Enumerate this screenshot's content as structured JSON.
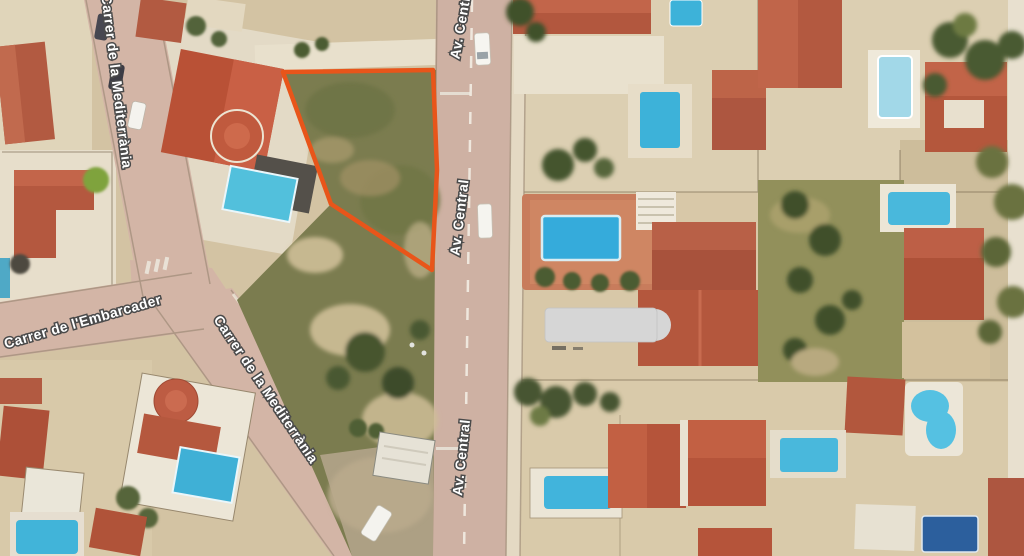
{
  "streets": {
    "mediterrania_north": "Carrer de la Mediterrània",
    "embarcader": "Carrer de l'Embarcader",
    "mediterrania_south": "Carrer de la Mediterrània",
    "av_central_top": "Av. Central",
    "av_central_mid": "Av. Central",
    "av_central_bottom": "Av. Central"
  },
  "parcel": {
    "outline_color": "#E8551A",
    "points": "283,72 433,70 437,170 432,270 331,204"
  },
  "palette": {
    "ground": "#D3C3A3",
    "road": "#D3B5A6",
    "roof": "#B5573E",
    "pool": "#41B4DC",
    "vegetation": "#46552F",
    "label_fill": "#FFFFFF",
    "label_outline": "#4A4A4A"
  }
}
